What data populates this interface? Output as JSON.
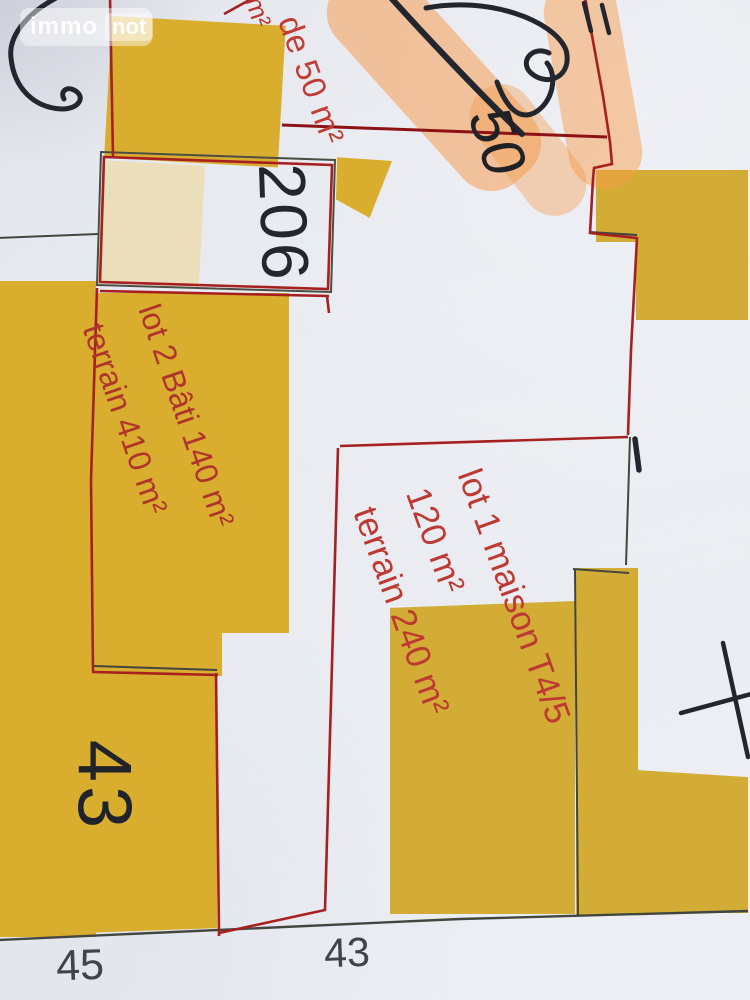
{
  "watermark": {
    "immo": "immo",
    "not": "not"
  },
  "handwriting": {
    "value": "50"
  },
  "labels": {
    "fragment_m2": "m²",
    "top_parcel": "de 50 m²",
    "parcel_206": "206",
    "lot2": {
      "line1": "lot 2 Bâti 140 m²",
      "line2": "terrain 410 m²"
    },
    "lot1": {
      "line1": "lot 1 maison T4/5",
      "line2": "120 m²",
      "line3": "terrain 240 m²"
    },
    "parcel_43": "43",
    "map_number_45": "45",
    "map_number_43": "43"
  },
  "colors": {
    "parcel_highlight": "#d9ae2f",
    "pale_highlight": "#eadfba",
    "highlighter_orange": "#f69a4a",
    "boundary_red": "#a6201f",
    "lot_text_red": "#b8342e",
    "ink_black": "#23262e",
    "map_number_gray": "#3f434c"
  }
}
